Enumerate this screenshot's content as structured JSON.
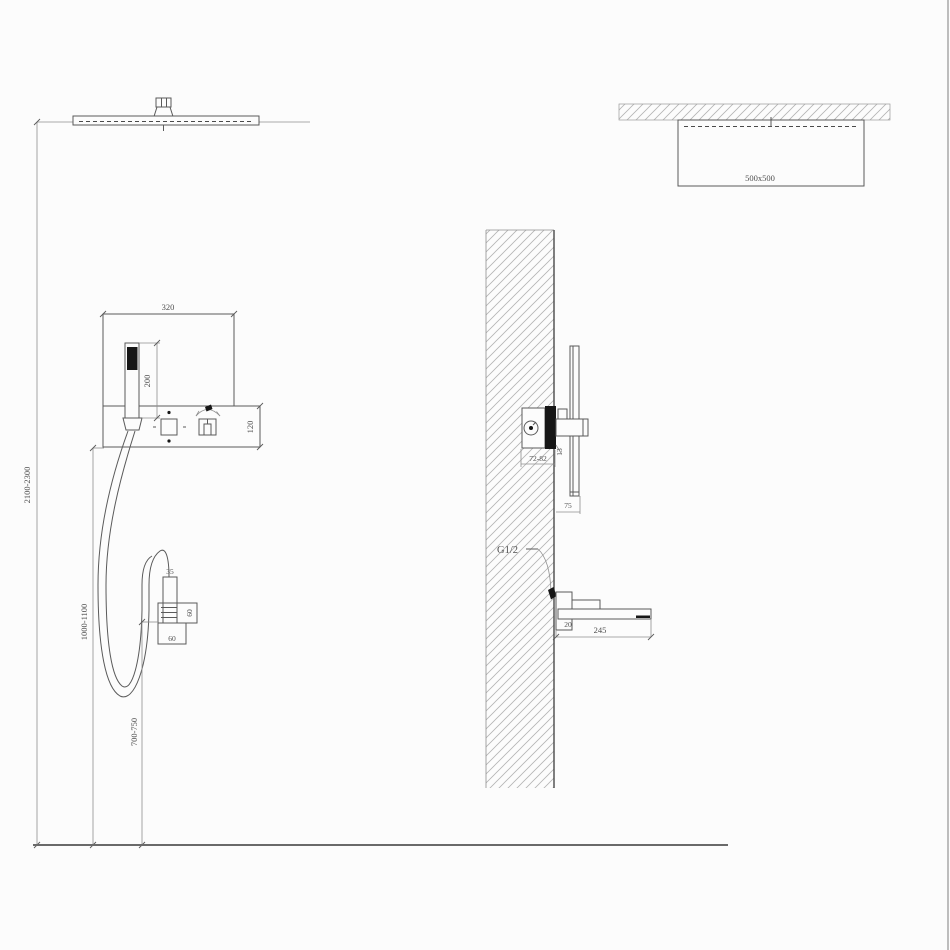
{
  "drawing": {
    "type": "shower-system-installation-diagram",
    "front_view": {
      "panel_width": "320",
      "handshower_length": "200",
      "panel_height": "120",
      "ceiling_height": "2100-2300",
      "mixer_height": "1000-1100",
      "outlet_height": "700-750",
      "holder_width": "35",
      "holder_depth": "60",
      "holder_base": "60"
    },
    "plan_view": {
      "head_size": "500x500"
    },
    "section_view": {
      "valve_depth": "72-82",
      "trim_depth": "13",
      "handle_clearance": "75",
      "thread": "G1/2",
      "spout_drop": "20",
      "spout_length": "245"
    },
    "colors": {
      "line": "#5a5a5a",
      "hatch": "#b4b4b4",
      "black_fill": "#161616",
      "text": "#4f4f4f",
      "background": "#fcfcfc"
    }
  }
}
